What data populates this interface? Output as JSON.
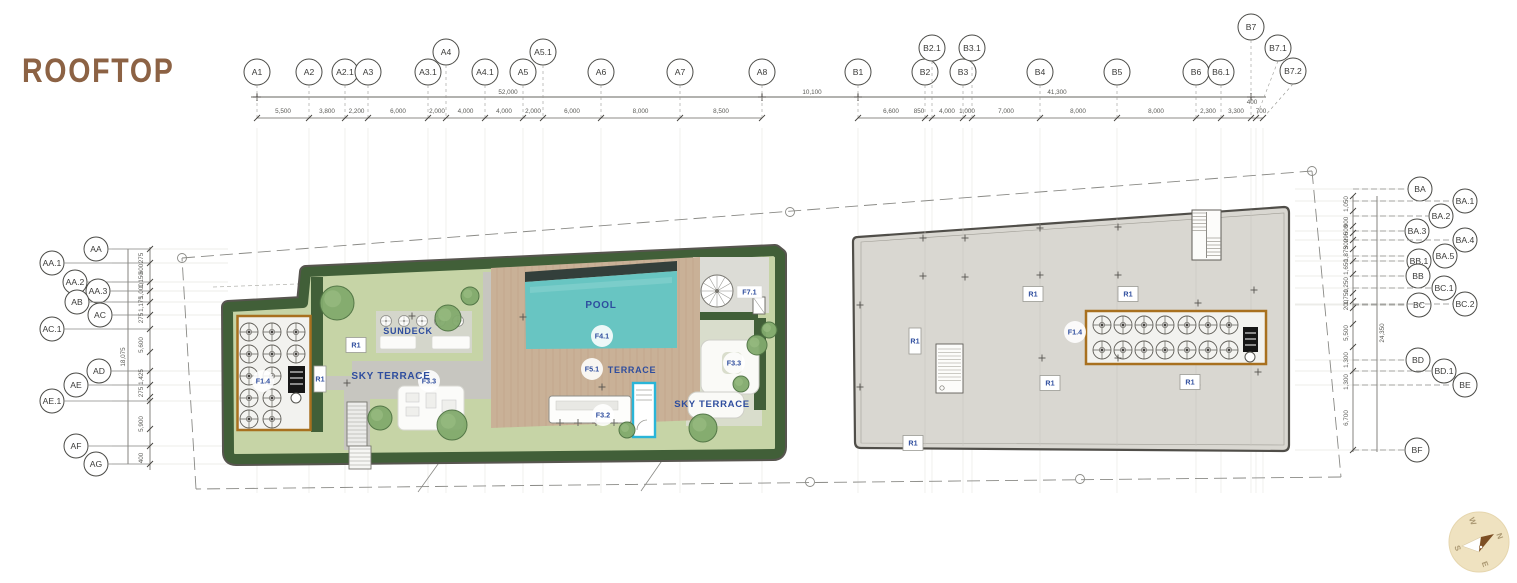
{
  "title": "ROOFTOP",
  "grid_top_a": {
    "labels": [
      "A1",
      "A2",
      "A2.1",
      "A3",
      "A3.1",
      "A4",
      "A4.1",
      "A5",
      "A5.1",
      "A6",
      "A7",
      "A8"
    ],
    "dims": [
      "5,500",
      "3,800",
      "2,200",
      "6,000",
      "2,000",
      "4,000",
      "4,000",
      "2,000",
      "6,000",
      "8,000",
      "8,500"
    ],
    "overall": "52,000"
  },
  "grid_top_b": {
    "labels": [
      "B1",
      "B2",
      "B2.1",
      "B3",
      "B3.1",
      "B4",
      "B5",
      "B6",
      "B6.1",
      "B7",
      "B7.1",
      "B7.2"
    ],
    "dims": [
      "6,600",
      "850",
      "4,000",
      "1,000",
      "7,000",
      "8,000",
      "8,000",
      "2,300",
      "3,300",
      "400",
      "700"
    ],
    "overall": "41,300",
    "gap": "10,100"
  },
  "grid_left": {
    "labels": [
      "AA",
      "AA.1",
      "AA.2",
      "AA.3",
      "AB",
      "AC",
      "AC.1",
      "AD",
      "AE",
      "AE.1",
      "AF",
      "AG"
    ],
    "dims": [
      "275",
      "600",
      "1,150",
      "1,000",
      "1,175",
      "275",
      "5,600",
      "1,425",
      "275",
      "5,900",
      "400"
    ],
    "overall": "18,075"
  },
  "grid_right": {
    "labels": [
      "BA",
      "BA.1",
      "BA.2",
      "BA.3",
      "BA.4",
      "BA.5",
      "BB.1",
      "BB",
      "BC.1",
      "BC",
      "BC.2",
      "BD",
      "BD.1",
      "BE",
      "BF"
    ],
    "dims": [
      "1,050",
      "900",
      "600",
      "295",
      "300",
      "1,875",
      "1,650",
      "1,250",
      "1,750",
      "200",
      "5,500",
      "1,300",
      "1,300",
      "6,700"
    ],
    "overall": "24,350"
  },
  "areas": {
    "pool": "POOL",
    "sundeck": "SUNDECK",
    "sky_terrace": "SKY TERRACE",
    "terrace": "TERRACE"
  },
  "badges": {
    "f14": "F1.4",
    "f41": "F4.1",
    "f51": "F5.1",
    "f32": "F3.2",
    "f33": "F3.3",
    "f71": "F7.1",
    "r1": "R1"
  },
  "compass": {
    "n": "N",
    "e": "E",
    "s": "S",
    "w": "W"
  },
  "colors": {
    "title": "#8c6244",
    "label_blue": "#2e4d9e",
    "hedge_green": "#415f38",
    "lawn_green": "#c6d4a6",
    "pool_teal": "#68c5c2",
    "deck_wood": "#c9b197",
    "roof_gray": "#d9d7d1",
    "equipment_border": "#a8701f"
  }
}
